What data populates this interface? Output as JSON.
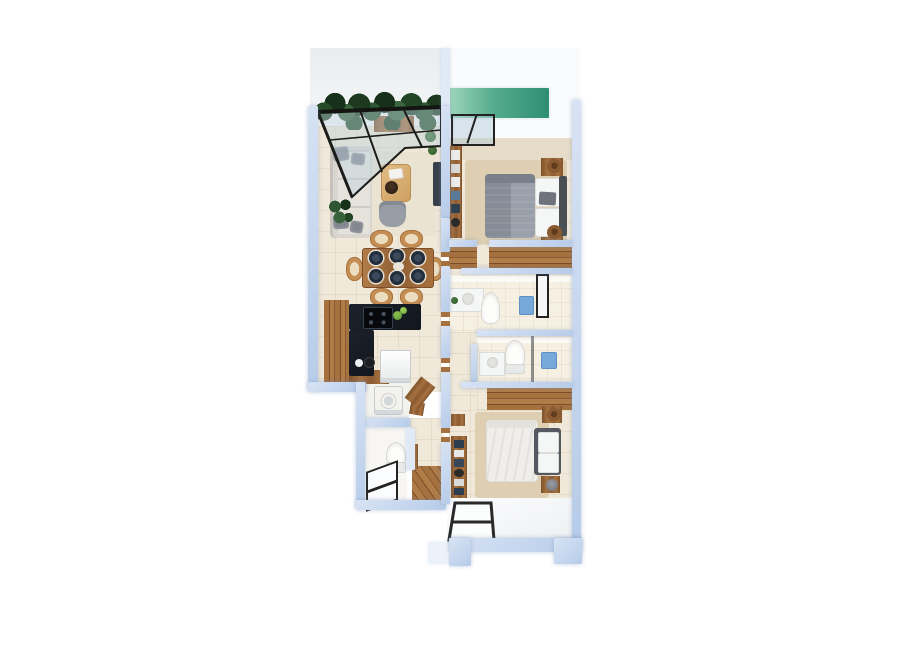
{
  "scene": {
    "kind": "3d-floor-plan-render",
    "description": "Top-down 3D architectural rendering of a two-bedroom apartment on a white background",
    "label": "Apartment floor plan"
  },
  "palette": {
    "wallA": "#d8e3f4",
    "wallB": "#b7cce9",
    "wallLight": "#e0eaf7",
    "floor": "#f0e8d8",
    "floorBath": "#f6f0e2",
    "exterior": "#e9edf0",
    "deck": "#fafbfc",
    "entry": "#eef0f3",
    "pool1": "#9fd6bd",
    "pool2": "#2f8e71",
    "wood1": "#8a5a32",
    "wood2": "#a5713f",
    "wood3": "#c48e55",
    "counter": "#12161d",
    "frame": "#232220",
    "sofa": "#d9d6d0",
    "cushion": "#e6e3dd",
    "pillow": "#83878f",
    "duvetA": "#878d96",
    "duvetB": "#9aa0a9",
    "duvetWhite": "#efeeea",
    "rug": "#decfb2",
    "rugLight": "#eae3d2",
    "fixture": "#76a9da",
    "white": "#f5f6f6",
    "dark": "#4a4e55",
    "hat1": "#8a5a30"
  },
  "rooms": {
    "terrace": {
      "label": "Terrace with vertical garden and glass pergola"
    },
    "pool": {
      "label": "Plunge pool"
    },
    "living": {
      "label": "Living room"
    },
    "dining": {
      "label": "Dining area"
    },
    "kitchen": {
      "label": "Kitchen"
    },
    "bedroom_main": {
      "label": "Main bedroom"
    },
    "closet_main": {
      "label": "Closet"
    },
    "bathroom_main": {
      "label": "Bathroom 1"
    },
    "corridor": {
      "label": "Corridor"
    },
    "bathroom_second": {
      "label": "Bathroom 2"
    },
    "laundry": {
      "label": "Laundry"
    },
    "bathroom_guest": {
      "label": "Guest bathroom"
    },
    "closet_second": {
      "label": "Closet 2"
    },
    "bedroom_second": {
      "label": "Bedroom 2"
    },
    "entry": {
      "label": "Entry hall"
    }
  },
  "furniture": {
    "hedge": {
      "label": "Vertical garden wall"
    },
    "pergola": {
      "label": "Glass pergola roof"
    },
    "bench": {
      "label": "Wood bench"
    },
    "sofa": {
      "label": "Sofa"
    },
    "coffee_table": {
      "label": "Coffee table"
    },
    "armchair": {
      "label": "Armchair"
    },
    "plant": {
      "label": "Potted plant"
    },
    "tv_panel": {
      "label": "TV panel"
    },
    "dining_table": {
      "label": "Dining table for six"
    },
    "chair": {
      "label": "Dining chair"
    },
    "plate": {
      "label": "Place setting"
    },
    "cabinets": {
      "label": "Kitchen cabinets"
    },
    "countertop": {
      "label": "Kitchen countertop"
    },
    "cooktop": {
      "label": "Cooktop"
    },
    "dishwasher": {
      "label": "Appliance"
    },
    "washer": {
      "label": "Washing machine"
    },
    "bed_main": {
      "label": "Double bed"
    },
    "bed_second": {
      "label": "Double bed"
    },
    "nightstand": {
      "label": "Nightstand with hat"
    },
    "wardrobe": {
      "label": "Wardrobe"
    },
    "vanity": {
      "label": "Vanity sink"
    },
    "toilet": {
      "label": "Toilet"
    },
    "shower": {
      "label": "Shower"
    },
    "shower_door": {
      "label": "Glass shower door"
    },
    "bookshelf": {
      "label": "Bookshelf"
    },
    "bench_bed": {
      "label": "Bed bench with cushions"
    },
    "skylight": {
      "label": "Glass skylight panels"
    },
    "window": {
      "label": "Black-framed window"
    }
  }
}
